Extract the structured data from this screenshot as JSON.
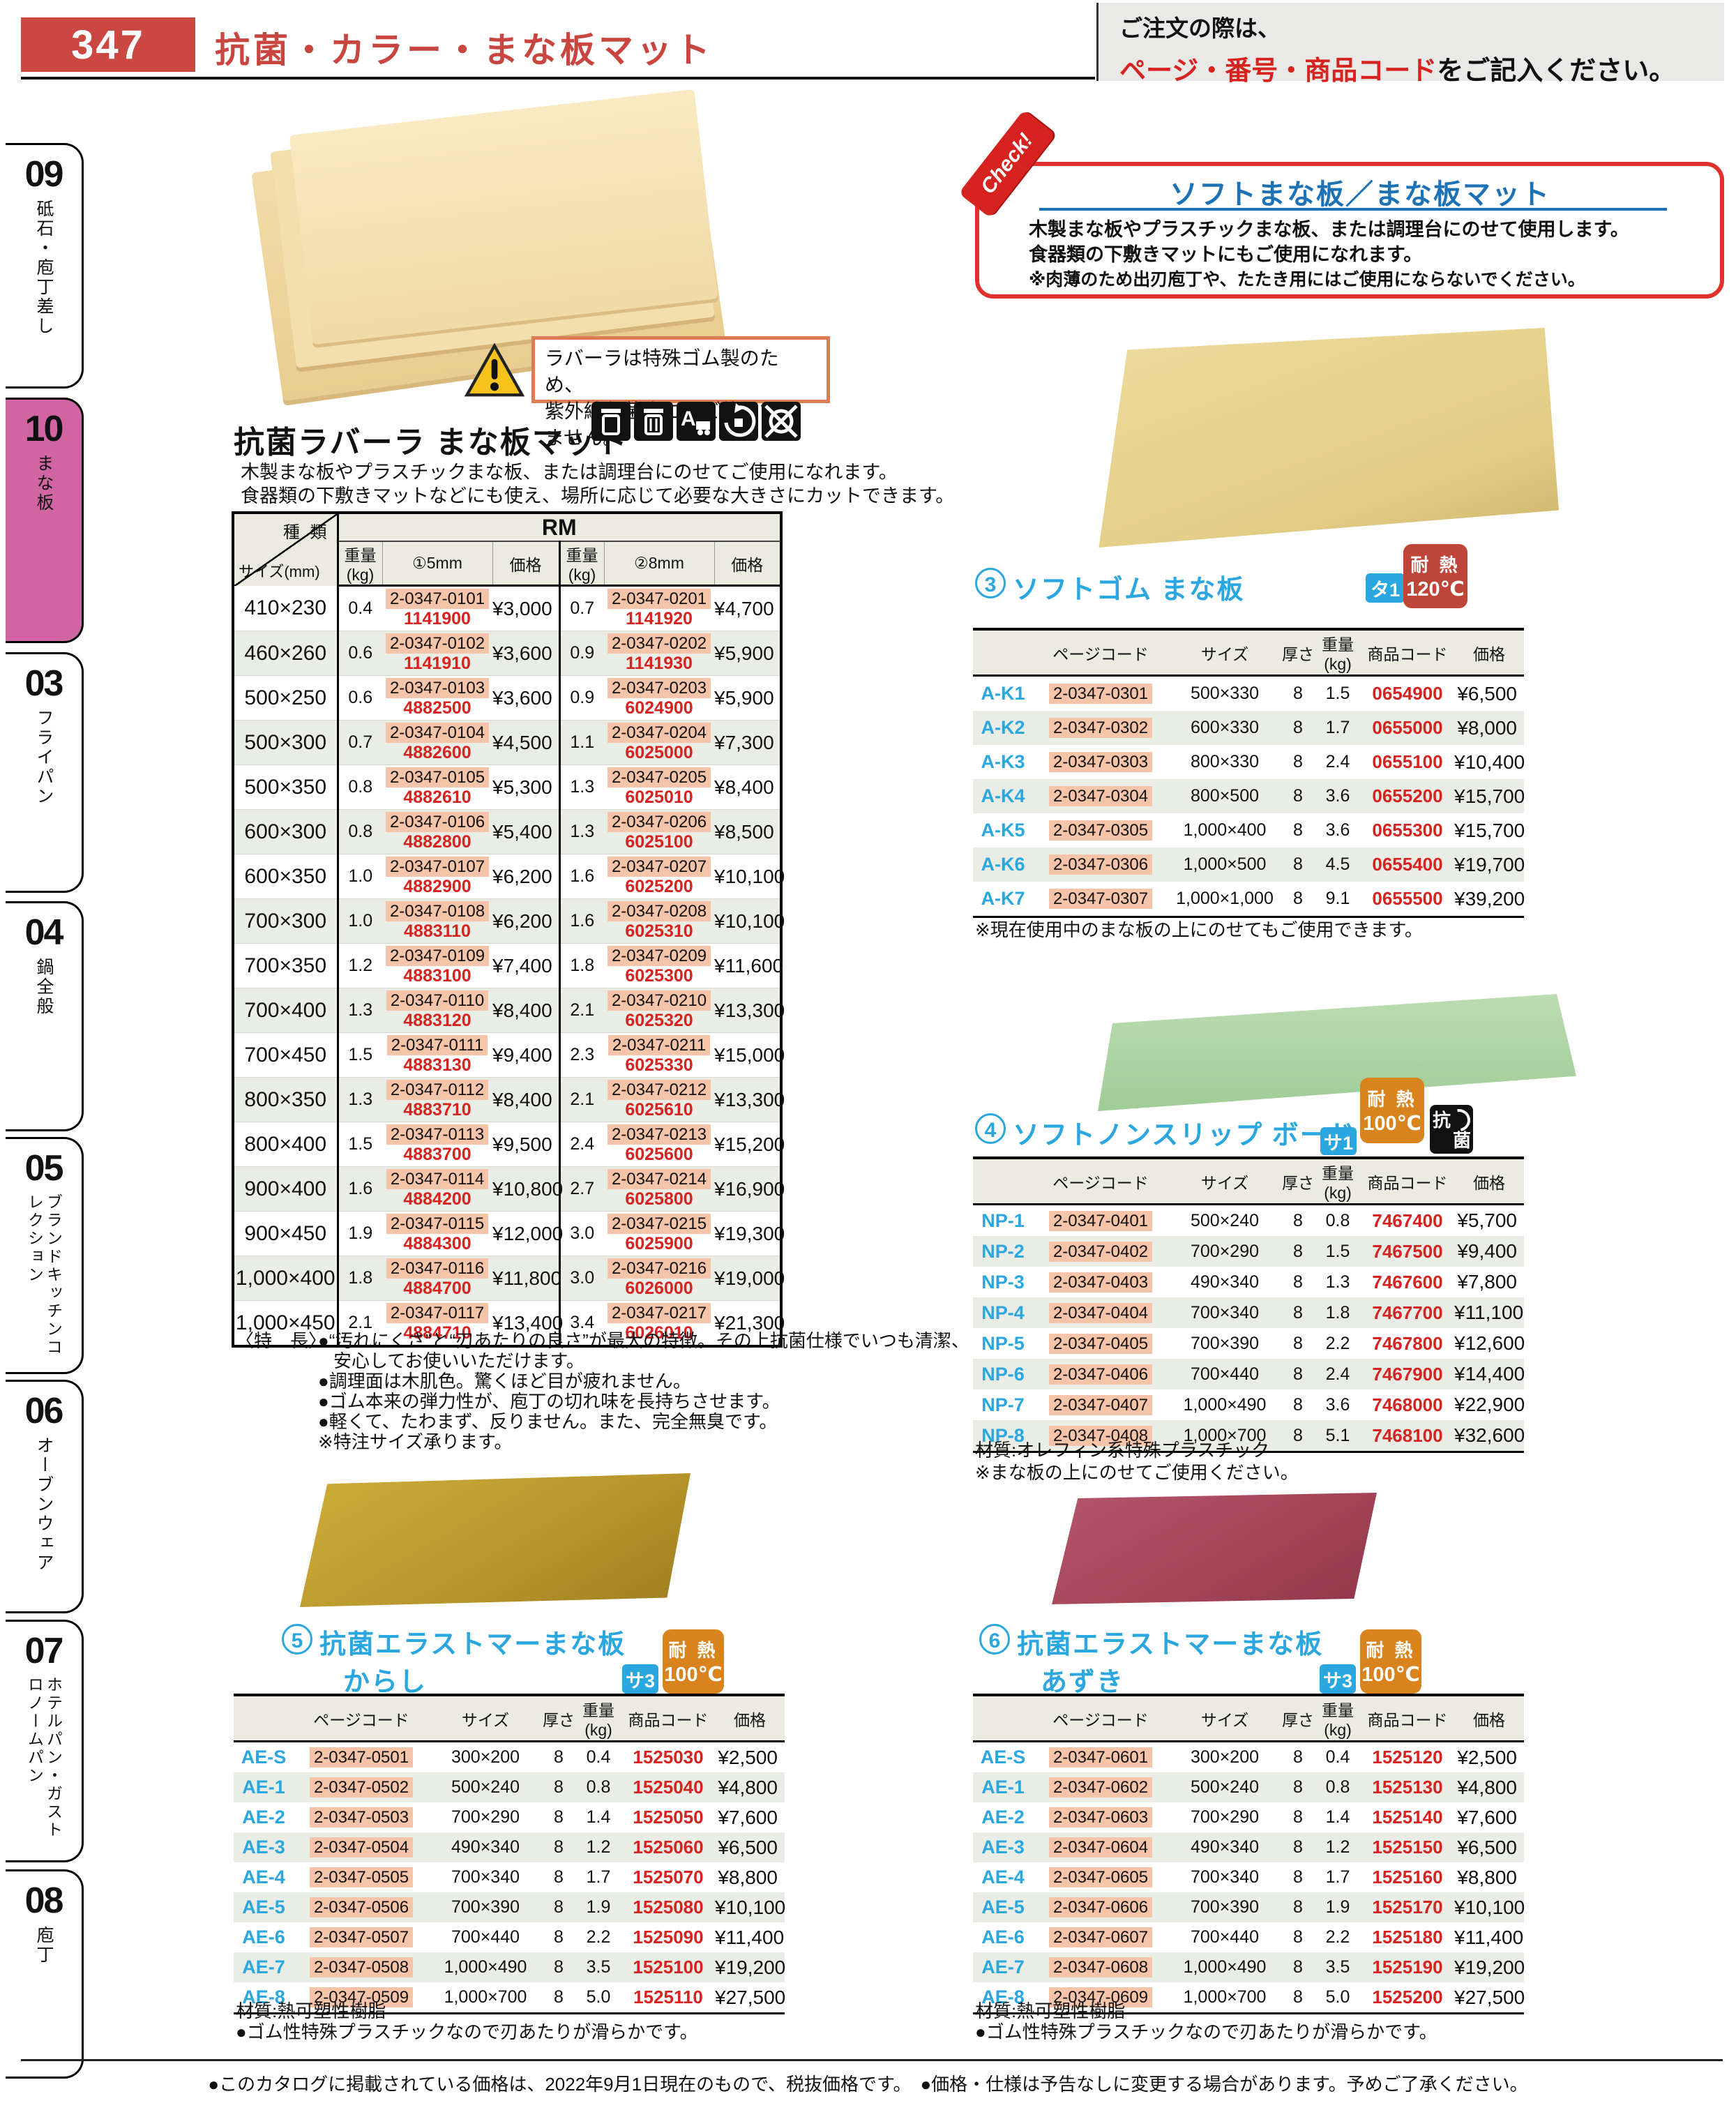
{
  "page": {
    "number": "347",
    "title": "抗菌・カラー・まな板マット"
  },
  "order_note": {
    "line1": "ご注文の際は、",
    "line2_red": "ページ・番号・商品コード",
    "line2_black": "をご記入ください。"
  },
  "sidebar": {
    "items": [
      {
        "num": "09",
        "label": "砥石・庖丁差し"
      },
      {
        "num": "10",
        "label": "まな板"
      },
      {
        "num": "03",
        "label": "フライパン"
      },
      {
        "num": "04",
        "label": "鍋全般"
      },
      {
        "num": "05",
        "label": "ブランドキッチンコレクション"
      },
      {
        "num": "06",
        "label": "オーブンウェア"
      },
      {
        "num": "07",
        "label": "ホテルパン・ガストロノームパン"
      },
      {
        "num": "08",
        "label": "庖丁"
      }
    ]
  },
  "check_box": {
    "ribbon": "Check!",
    "title": "ソフトまな板／まな板マット",
    "lines": [
      "木製まな板やプラスチックまな板、または調理台にのせて使用します。",
      "食器類の下敷きマットにもご使用になれます。",
      "※肉薄のため出刃庖丁や、たたき用にはご使用にならないでください。"
    ]
  },
  "warning": {
    "line1": "ラバーラは特殊ゴム製のため、",
    "line2": "紫外線殺菌庫にはご使用できません。"
  },
  "icons": {
    "names": [
      "trash-bin-icon",
      "sorted-bin-icon",
      "a-transport-icon",
      "antibacterial-icon",
      "no-uv-recycle-icon"
    ],
    "anti1": "抗",
    "anti2": "菌"
  },
  "sub_headers": [
    "ページコード",
    "サイズ",
    "厚さ",
    "重量(kg)",
    "商品コード",
    "価格"
  ],
  "rubber_mat": {
    "title": "抗菌ラバーラ まな板マット",
    "desc1": "木製まな板やプラスチックまな板、または調理台にのせてご使用になれます。",
    "desc2": "食器類の下敷きマットなどにも使え、場所に応じて必要な大きさにカットできます。",
    "table": {
      "corner_top": "種 類",
      "corner_bottom": "サイズ(mm)",
      "group": "RM",
      "col_headers": [
        "重量(kg)",
        "①5mm",
        "価格",
        "重量(kg)",
        "②8mm",
        "価格"
      ],
      "rows": [
        {
          "size": "410×230",
          "w5": "0.4",
          "page5": "2-0347-0101",
          "code5": "1141900",
          "price5": "¥3,000",
          "w8": "0.7",
          "page8": "2-0347-0201",
          "code8": "1141920",
          "price8": "¥4,700"
        },
        {
          "size": "460×260",
          "w5": "0.6",
          "page5": "2-0347-0102",
          "code5": "1141910",
          "price5": "¥3,600",
          "w8": "0.9",
          "page8": "2-0347-0202",
          "code8": "1141930",
          "price8": "¥5,900"
        },
        {
          "size": "500×250",
          "w5": "0.6",
          "page5": "2-0347-0103",
          "code5": "4882500",
          "price5": "¥3,600",
          "w8": "0.9",
          "page8": "2-0347-0203",
          "code8": "6024900",
          "price8": "¥5,900"
        },
        {
          "size": "500×300",
          "w5": "0.7",
          "page5": "2-0347-0104",
          "code5": "4882600",
          "price5": "¥4,500",
          "w8": "1.1",
          "page8": "2-0347-0204",
          "code8": "6025000",
          "price8": "¥7,300"
        },
        {
          "size": "500×350",
          "w5": "0.8",
          "page5": "2-0347-0105",
          "code5": "4882610",
          "price5": "¥5,300",
          "w8": "1.3",
          "page8": "2-0347-0205",
          "code8": "6025010",
          "price8": "¥8,400"
        },
        {
          "size": "600×300",
          "w5": "0.8",
          "page5": "2-0347-0106",
          "code5": "4882800",
          "price5": "¥5,400",
          "w8": "1.3",
          "page8": "2-0347-0206",
          "code8": "6025100",
          "price8": "¥8,500"
        },
        {
          "size": "600×350",
          "w5": "1.0",
          "page5": "2-0347-0107",
          "code5": "4882900",
          "price5": "¥6,200",
          "w8": "1.6",
          "page8": "2-0347-0207",
          "code8": "6025200",
          "price8": "¥10,100"
        },
        {
          "size": "700×300",
          "w5": "1.0",
          "page5": "2-0347-0108",
          "code5": "4883110",
          "price5": "¥6,200",
          "w8": "1.6",
          "page8": "2-0347-0208",
          "code8": "6025310",
          "price8": "¥10,100"
        },
        {
          "size": "700×350",
          "w5": "1.2",
          "page5": "2-0347-0109",
          "code5": "4883100",
          "price5": "¥7,400",
          "w8": "1.8",
          "page8": "2-0347-0209",
          "code8": "6025300",
          "price8": "¥11,600"
        },
        {
          "size": "700×400",
          "w5": "1.3",
          "page5": "2-0347-0110",
          "code5": "4883120",
          "price5": "¥8,400",
          "w8": "2.1",
          "page8": "2-0347-0210",
          "code8": "6025320",
          "price8": "¥13,300"
        },
        {
          "size": "700×450",
          "w5": "1.5",
          "page5": "2-0347-0111",
          "code5": "4883130",
          "price5": "¥9,400",
          "w8": "2.3",
          "page8": "2-0347-0211",
          "code8": "6025330",
          "price8": "¥15,000"
        },
        {
          "size": "800×350",
          "w5": "1.3",
          "page5": "2-0347-0112",
          "code5": "4883710",
          "price5": "¥8,400",
          "w8": "2.1",
          "page8": "2-0347-0212",
          "code8": "6025610",
          "price8": "¥13,300"
        },
        {
          "size": "800×400",
          "w5": "1.5",
          "page5": "2-0347-0113",
          "code5": "4883700",
          "price5": "¥9,500",
          "w8": "2.4",
          "page8": "2-0347-0213",
          "code8": "6025600",
          "price8": "¥15,200"
        },
        {
          "size": "900×400",
          "w5": "1.6",
          "page5": "2-0347-0114",
          "code5": "4884200",
          "price5": "¥10,800",
          "w8": "2.7",
          "page8": "2-0347-0214",
          "code8": "6025800",
          "price8": "¥16,900"
        },
        {
          "size": "900×450",
          "w5": "1.9",
          "page5": "2-0347-0115",
          "code5": "4884300",
          "price5": "¥12,000",
          "w8": "3.0",
          "page8": "2-0347-0215",
          "code8": "6025900",
          "price8": "¥19,300"
        },
        {
          "size": "1,000×400",
          "w5": "1.8",
          "page5": "2-0347-0116",
          "code5": "4884700",
          "price5": "¥11,800",
          "w8": "3.0",
          "page8": "2-0347-0216",
          "code8": "6026000",
          "price8": "¥19,000"
        },
        {
          "size": "1,000×450",
          "w5": "2.1",
          "page5": "2-0347-0117",
          "code5": "4884710",
          "price5": "¥13,400",
          "w8": "3.4",
          "page8": "2-0347-0217",
          "code8": "6026010",
          "price8": "¥21,300"
        }
      ]
    },
    "features_label": "〈特　長〉",
    "features": [
      "●“汚れにくさ”と“刃あたりの良さ”が最大の特徴。その上抗菌仕様でいつも清潔、",
      "安心してお使いいただけます。",
      "●調理面は木肌色。驚くほど目が疲れません。",
      "●ゴム本来の弾力性が、庖丁の切れ味を長持ちさせます。",
      "●軽くて、たわまず、反りません。また、完全無臭です。",
      "※特注サイズ承ります。"
    ]
  },
  "soft_rubber": {
    "num": "3",
    "title": "ソフトゴム まな板",
    "category_badge": "タ1",
    "heat_label": "耐 熱",
    "heat_temp": "120℃",
    "rows": [
      {
        "model": "A-K1",
        "page": "2-0347-0301",
        "size": "500×330",
        "t": "8",
        "w": "1.5",
        "code": "0654900",
        "price": "¥6,500"
      },
      {
        "model": "A-K2",
        "page": "2-0347-0302",
        "size": "600×330",
        "t": "8",
        "w": "1.7",
        "code": "0655000",
        "price": "¥8,000"
      },
      {
        "model": "A-K3",
        "page": "2-0347-0303",
        "size": "800×330",
        "t": "8",
        "w": "2.4",
        "code": "0655100",
        "price": "¥10,400"
      },
      {
        "model": "A-K4",
        "page": "2-0347-0304",
        "size": "800×500",
        "t": "8",
        "w": "3.6",
        "code": "0655200",
        "price": "¥15,700"
      },
      {
        "model": "A-K5",
        "page": "2-0347-0305",
        "size": "1,000×400",
        "t": "8",
        "w": "3.6",
        "code": "0655300",
        "price": "¥15,700"
      },
      {
        "model": "A-K6",
        "page": "2-0347-0306",
        "size": "1,000×500",
        "t": "8",
        "w": "4.5",
        "code": "0655400",
        "price": "¥19,700"
      },
      {
        "model": "A-K7",
        "page": "2-0347-0307",
        "size": "1,000×1,000",
        "t": "8",
        "w": "9.1",
        "code": "0655500",
        "price": "¥39,200"
      }
    ],
    "note": "※現在使用中のまな板の上にのせてもご使用できます。"
  },
  "nonslip": {
    "num": "4",
    "title": "ソフトノンスリップ ボード",
    "category_badge": "サ1",
    "heat_label": "耐 熱",
    "heat_temp": "100℃",
    "rows": [
      {
        "model": "NP-1",
        "page": "2-0347-0401",
        "size": "500×240",
        "t": "8",
        "w": "0.8",
        "code": "7467400",
        "price": "¥5,700"
      },
      {
        "model": "NP-2",
        "page": "2-0347-0402",
        "size": "700×290",
        "t": "8",
        "w": "1.5",
        "code": "7467500",
        "price": "¥9,400"
      },
      {
        "model": "NP-3",
        "page": "2-0347-0403",
        "size": "490×340",
        "t": "8",
        "w": "1.3",
        "code": "7467600",
        "price": "¥7,800"
      },
      {
        "model": "NP-4",
        "page": "2-0347-0404",
        "size": "700×340",
        "t": "8",
        "w": "1.8",
        "code": "7467700",
        "price": "¥11,100"
      },
      {
        "model": "NP-5",
        "page": "2-0347-0405",
        "size": "700×390",
        "t": "8",
        "w": "2.2",
        "code": "7467800",
        "price": "¥12,600"
      },
      {
        "model": "NP-6",
        "page": "2-0347-0406",
        "size": "700×440",
        "t": "8",
        "w": "2.4",
        "code": "7467900",
        "price": "¥14,400"
      },
      {
        "model": "NP-7",
        "page": "2-0347-0407",
        "size": "1,000×490",
        "t": "8",
        "w": "3.6",
        "code": "7468000",
        "price": "¥22,900"
      },
      {
        "model": "NP-8",
        "page": "2-0347-0408",
        "size": "1,000×700",
        "t": "8",
        "w": "5.1",
        "code": "7468100",
        "price": "¥32,600"
      }
    ],
    "notes": [
      "材質:オレフィン系特殊プラスチック",
      "※まな板の上にのせてご使用ください。"
    ]
  },
  "karashi": {
    "num": "5",
    "title": "抗菌エラストマーまな板",
    "subtitle": "からし",
    "category_badge": "サ3",
    "heat_label": "耐 熱",
    "heat_temp": "100℃",
    "rows": [
      {
        "model": "AE-S",
        "page": "2-0347-0501",
        "size": "300×200",
        "t": "8",
        "w": "0.4",
        "code": "1525030",
        "price": "¥2,500"
      },
      {
        "model": "AE-1",
        "page": "2-0347-0502",
        "size": "500×240",
        "t": "8",
        "w": "0.8",
        "code": "1525040",
        "price": "¥4,800"
      },
      {
        "model": "AE-2",
        "page": "2-0347-0503",
        "size": "700×290",
        "t": "8",
        "w": "1.4",
        "code": "1525050",
        "price": "¥7,600"
      },
      {
        "model": "AE-3",
        "page": "2-0347-0504",
        "size": "490×340",
        "t": "8",
        "w": "1.2",
        "code": "1525060",
        "price": "¥6,500"
      },
      {
        "model": "AE-4",
        "page": "2-0347-0505",
        "size": "700×340",
        "t": "8",
        "w": "1.7",
        "code": "1525070",
        "price": "¥8,800"
      },
      {
        "model": "AE-5",
        "page": "2-0347-0506",
        "size": "700×390",
        "t": "8",
        "w": "1.9",
        "code": "1525080",
        "price": "¥10,100"
      },
      {
        "model": "AE-6",
        "page": "2-0347-0507",
        "size": "700×440",
        "t": "8",
        "w": "2.2",
        "code": "1525090",
        "price": "¥11,400"
      },
      {
        "model": "AE-7",
        "page": "2-0347-0508",
        "size": "1,000×490",
        "t": "8",
        "w": "3.5",
        "code": "1525100",
        "price": "¥19,200"
      },
      {
        "model": "AE-8",
        "page": "2-0347-0509",
        "size": "1,000×700",
        "t": "8",
        "w": "5.0",
        "code": "1525110",
        "price": "¥27,500"
      }
    ],
    "notes": [
      "材質:熱可塑性樹脂",
      "●ゴム性特殊プラスチックなので刃あたりが滑らかです。"
    ]
  },
  "azuki": {
    "num": "6",
    "title": "抗菌エラストマーまな板",
    "subtitle": "あずき",
    "category_badge": "サ3",
    "heat_label": "耐 熱",
    "heat_temp": "100℃",
    "rows": [
      {
        "model": "AE-S",
        "page": "2-0347-0601",
        "size": "300×200",
        "t": "8",
        "w": "0.4",
        "code": "1525120",
        "price": "¥2,500"
      },
      {
        "model": "AE-1",
        "page": "2-0347-0602",
        "size": "500×240",
        "t": "8",
        "w": "0.8",
        "code": "1525130",
        "price": "¥4,800"
      },
      {
        "model": "AE-2",
        "page": "2-0347-0603",
        "size": "700×290",
        "t": "8",
        "w": "1.4",
        "code": "1525140",
        "price": "¥7,600"
      },
      {
        "model": "AE-3",
        "page": "2-0347-0604",
        "size": "490×340",
        "t": "8",
        "w": "1.2",
        "code": "1525150",
        "price": "¥6,500"
      },
      {
        "model": "AE-4",
        "page": "2-0347-0605",
        "size": "700×340",
        "t": "8",
        "w": "1.7",
        "code": "1525160",
        "price": "¥8,800"
      },
      {
        "model": "AE-5",
        "page": "2-0347-0606",
        "size": "700×390",
        "t": "8",
        "w": "1.9",
        "code": "1525170",
        "price": "¥10,100"
      },
      {
        "model": "AE-6",
        "page": "2-0347-0607",
        "size": "700×440",
        "t": "8",
        "w": "2.2",
        "code": "1525180",
        "price": "¥11,400"
      },
      {
        "model": "AE-7",
        "page": "2-0347-0608",
        "size": "1,000×490",
        "t": "8",
        "w": "3.5",
        "code": "1525190",
        "price": "¥19,200"
      },
      {
        "model": "AE-8",
        "page": "2-0347-0609",
        "size": "1,000×700",
        "t": "8",
        "w": "5.0",
        "code": "1525200",
        "price": "¥27,500"
      }
    ],
    "notes": [
      "材質:熱可塑性樹脂",
      "●ゴム性特殊プラスチックなので刃あたりが滑らかです。"
    ]
  },
  "footer": {
    "left": "●このカタログに掲載されている価格は、2022年9月1日現在のもので、税抜価格です。",
    "right": "●価格・仕様は予告なしに変更する場合があります。予めご了承ください。"
  }
}
